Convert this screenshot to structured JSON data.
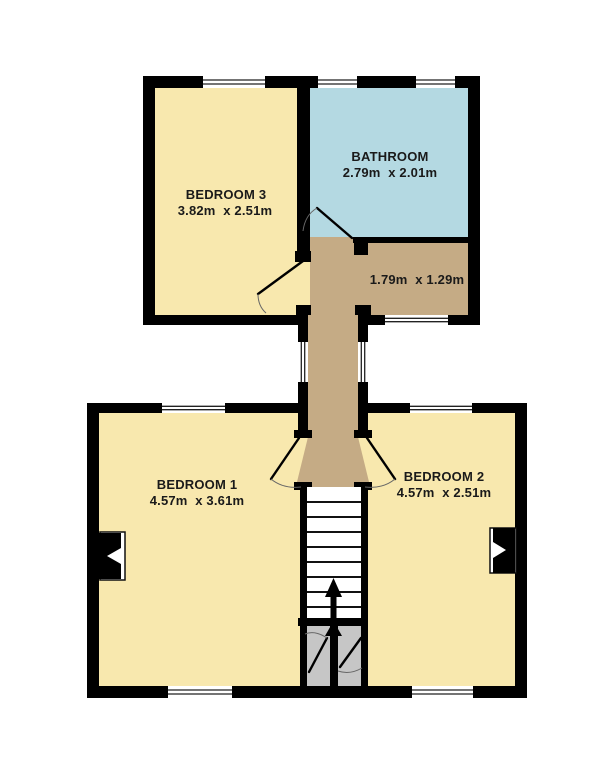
{
  "plan": {
    "type": "floor-plan",
    "colors": {
      "wall": "#000000",
      "bedroom_fill": "#f8e8ae",
      "bathroom_fill": "#b4d9e2",
      "landing_fill": "#c5ab85",
      "cupboard_fill": "#c6c6c6",
      "stairs_fill": "#ffffff",
      "label_color": "#1a1a1a",
      "background": "#ffffff"
    },
    "rooms": {
      "bedroom3": {
        "label": "BEDROOM 3",
        "dims": "3.82m  x 2.51m"
      },
      "bathroom": {
        "label": "BATHROOM",
        "dims": "2.79m  x 2.01m"
      },
      "landing": {
        "dims": "1.79m  x 1.29m"
      },
      "bedroom1": {
        "label": "BEDROOM 1",
        "dims": "4.57m  x 3.61m"
      },
      "bedroom2": {
        "label": "BEDROOM 2",
        "dims": "4.57m  x 2.51m"
      }
    }
  }
}
